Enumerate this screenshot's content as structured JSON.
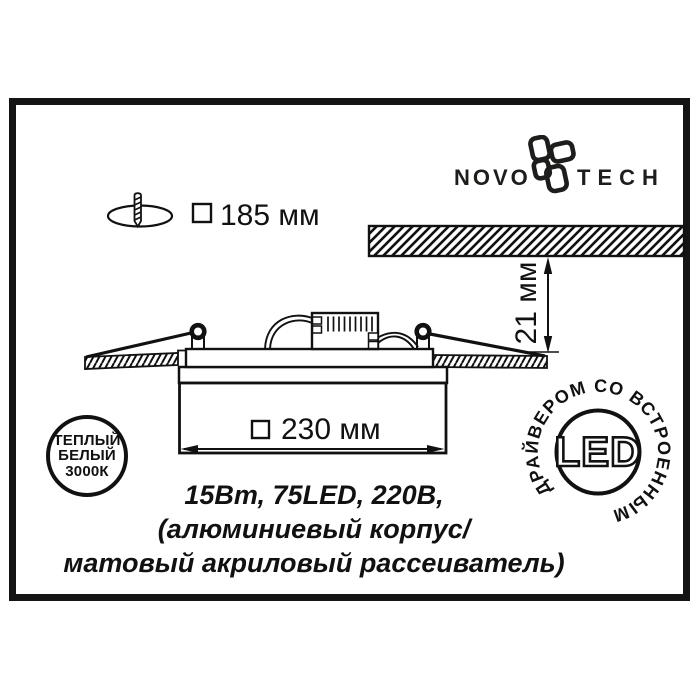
{
  "colors": {
    "ink": "#111111",
    "bg": "#ffffff"
  },
  "logo": {
    "name_left": "NOVO",
    "name_right": "TECH"
  },
  "cutout": {
    "label": "185 мм"
  },
  "recess_depth": {
    "label": "21 мм"
  },
  "fixture_width": {
    "label": "230 мм"
  },
  "badge_color_temp": {
    "line1": "ТЕПЛЫЙ",
    "line2": "БЕЛЫЙ",
    "line3": "3000К"
  },
  "badge_led": {
    "center_label": "LED",
    "ring_label": "ДРАЙВЕРОМ СО ВСТРОЕННЫМ"
  },
  "specs": {
    "line1": "15Вт, 75LED, 220В,",
    "line2": "(алюминиевый корпус/",
    "line3": "матовый акриловый рассеиватель)"
  }
}
